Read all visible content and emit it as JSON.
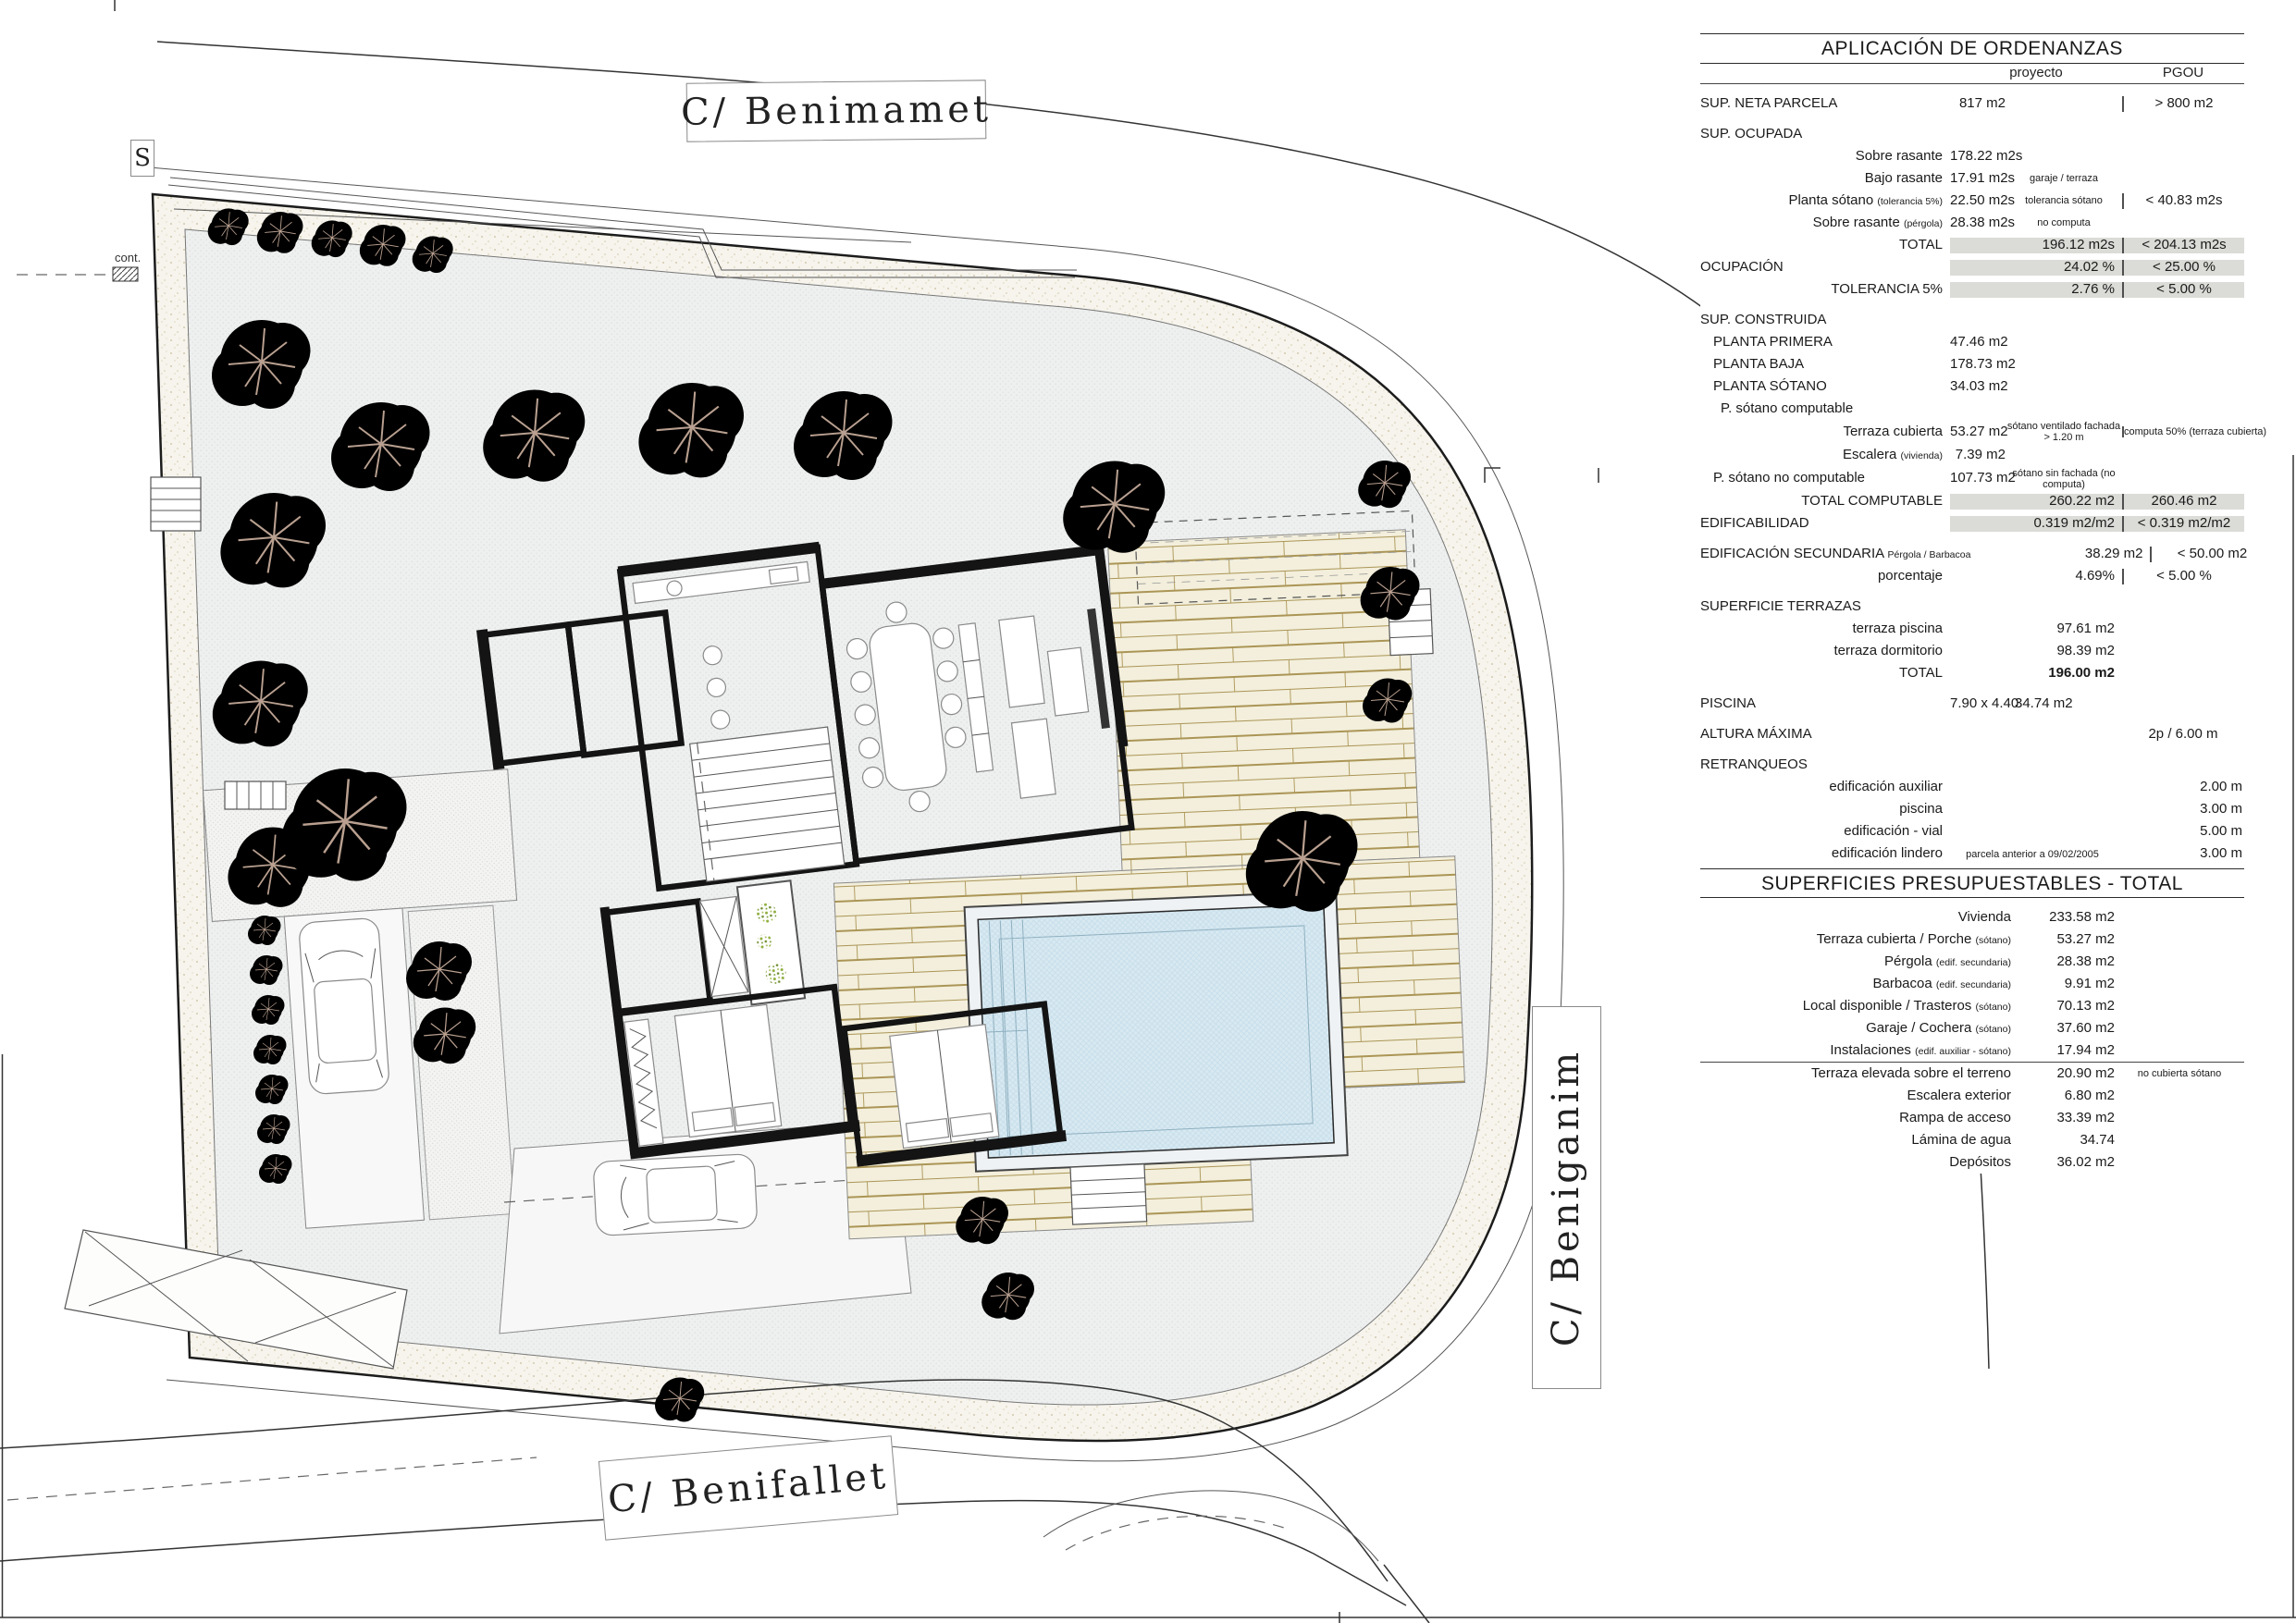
{
  "plan": {
    "street_top": "C/  Benimamet",
    "street_bottom": "C/  Benifallet",
    "street_right": "C/  Beniganim",
    "section_marker": "S",
    "cont_label": "cont.",
    "colors": {
      "garden": "#eef0ef",
      "band_speckle": "#c8bc9c",
      "deck": "#f3efdc",
      "pool": "#d8e9f1",
      "tree_green": "#8fae3e",
      "tree_brown": "#b08c48",
      "wall": "#141414",
      "highlight_gray": "#dbdbd7"
    }
  },
  "ord": {
    "title": "APLICACIÓN DE ORDENANZAS",
    "col_proyecto": "proyecto",
    "col_pgou": "PGOU",
    "rows": {
      "neta": {
        "label": "SUP. NETA PARCELA",
        "v": "817 m2",
        "pgou": "> 800 m2"
      },
      "ocupada": {
        "label": "SUP. OCUPADA"
      },
      "sobre1": {
        "label": "Sobre rasante",
        "v": "178.22 m2s"
      },
      "bajo": {
        "label": "Bajo rasante",
        "v": "17.91 m2s",
        "note": "garaje / terraza"
      },
      "sotano5": {
        "label": "Planta sótano",
        "sub": "(tolerancia 5%)",
        "v": "22.50 m2s",
        "note": "tolerancia sótano",
        "pgou": "< 40.83 m2s"
      },
      "pergola": {
        "label": "Sobre rasante",
        "sub": "(pérgola)",
        "v": "28.38 m2s",
        "note": "no computa"
      },
      "total1": {
        "label": "TOTAL",
        "v": "196.12 m2s",
        "pgou": "< 204.13 m2s"
      },
      "ocupacion": {
        "label": "OCUPACIÓN",
        "v": "24.02 %",
        "pgou": "< 25.00 %"
      },
      "tolerancia": {
        "label": "TOLERANCIA 5%",
        "v": "2.76 %",
        "pgou": "< 5.00 %"
      },
      "construida": {
        "label": "SUP. CONSTRUIDA"
      },
      "p1": {
        "label": "PLANTA PRIMERA",
        "v": "47.46 m2"
      },
      "pb": {
        "label": "PLANTA BAJA",
        "v": "178.73 m2"
      },
      "ps": {
        "label": "PLANTA SÓTANO",
        "v": "34.03 m2"
      },
      "psc": {
        "label": "P. sótano computable"
      },
      "tc": {
        "label": "Terraza cubierta",
        "v": "53.27 m2",
        "note": "sótano ventilado fachada > 1.20 m",
        "pgou_note": "computa 50% (terraza cubierta)"
      },
      "esc": {
        "label": "Escalera",
        "sub": "(vivienda)",
        "v": "7.39 m2"
      },
      "psnc": {
        "label": "P. sótano no computable",
        "v": "107.73 m2",
        "note": "sótano sin fachada (no computa)"
      },
      "totalc": {
        "label": "TOTAL COMPUTABLE",
        "v": "260.22 m2",
        "pgou": "260.46 m2"
      },
      "edif": {
        "label": "EDIFICABILIDAD",
        "v": "0.319 m2/m2",
        "pgou": "< 0.319 m2/m2"
      },
      "sec": {
        "label": "EDIFICACIÓN SECUNDARIA",
        "note": "Pérgola / Barbacoa",
        "v": "38.29 m2",
        "pgou": "< 50.00 m2"
      },
      "porc": {
        "label": "porcentaje",
        "v": "4.69%",
        "pgou": "< 5.00 %"
      },
      "terrazas": {
        "label": "SUPERFICIE TERRAZAS"
      },
      "tp": {
        "label": "terraza piscina",
        "v": "97.61 m2"
      },
      "td": {
        "label": "terraza dormitorio",
        "v": "98.39 m2"
      },
      "tt": {
        "label": "TOTAL",
        "v": "196.00 m2"
      },
      "piscina": {
        "label": "PISCINA",
        "dim": "7.90 x 4.40",
        "v": "34.74 m2"
      },
      "altura": {
        "label": "ALTURA MÁXIMA",
        "pgou": "2p / 6.00 m"
      },
      "retr": {
        "label": "RETRANQUEOS"
      },
      "ra": {
        "label": "edificación auxiliar",
        "pgou": "2.00 m"
      },
      "rp": {
        "label": "piscina",
        "pgou": "3.00 m"
      },
      "rv": {
        "label": "edificación - vial",
        "pgou": "5.00 m"
      },
      "rl": {
        "label": "edificación  lindero",
        "note": "parcela anterior a 09/02/2005",
        "pgou": "3.00 m"
      }
    }
  },
  "pres": {
    "title": "SUPERFICIES PRESUPUESTABLES - TOTAL",
    "rows": {
      "viv": {
        "label": "Vivienda",
        "v": "233.58 m2"
      },
      "tcp": {
        "label": "Terraza cubierta / Porche",
        "sub": "(sótano)",
        "v": "53.27 m2"
      },
      "per": {
        "label": "Pérgola",
        "sub": "(edif. secundaria)",
        "v": "28.38 m2"
      },
      "bar": {
        "label": "Barbacoa",
        "sub": "(edif. secundaria)",
        "v": "9.91 m2"
      },
      "loc": {
        "label": "Local disponible / Trasteros",
        "sub": "(sótano)",
        "v": "70.13 m2"
      },
      "gar": {
        "label": "Garaje / Cochera",
        "sub": "(sótano)",
        "v": "37.60 m2"
      },
      "ins": {
        "label": "Instalaciones",
        "sub": "(edif. auxiliar - sótano)",
        "v": "17.94 m2"
      },
      "te": {
        "label": "Terraza elevada sobre el terreno",
        "v": "20.90 m2",
        "note": "no cubierta sótano"
      },
      "ee": {
        "label": "Escalera exterior",
        "v": "6.80 m2"
      },
      "ram": {
        "label": "Rampa de acceso",
        "v": "33.39 m2"
      },
      "lam": {
        "label": "Lámina de agua",
        "v": "34.74"
      },
      "dep": {
        "label": "Depósitos",
        "v": "36.02 m2"
      }
    }
  }
}
